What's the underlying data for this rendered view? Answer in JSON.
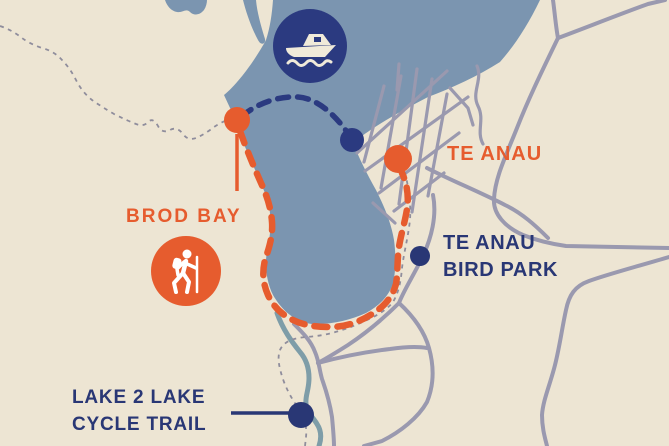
{
  "map": {
    "labels": {
      "te_anau": "TE ANAU",
      "brod_bay": "BROD BAY",
      "bird_park_line1": "TE ANAU",
      "bird_park_line2": "BIRD PARK",
      "cycle_trail_line1": "LAKE 2 LAKE",
      "cycle_trail_line2": "CYCLE TRAIL"
    },
    "colors": {
      "background_cream": "#ede5d3",
      "lake_blue": "#7b95b0",
      "orange_accent": "#e65c2e",
      "navy_accent": "#2b3a80",
      "text_navy": "#293775",
      "road_gray": "#9a99af",
      "trail_dot_gray": "#8f8d9c",
      "river_teal": "#7e9da8",
      "icon_cream": "#f0ead9"
    },
    "icons": [
      {
        "name": "boat-icon",
        "meaning": "boat cruise marker"
      },
      {
        "name": "hiker-icon",
        "meaning": "walking track marker"
      }
    ],
    "markers": [
      {
        "name": "brod-bay-marker",
        "color": "#e65c2e"
      },
      {
        "name": "boat-harbor-dot",
        "color": "#2b3a80"
      },
      {
        "name": "te-anau-dot",
        "color": "#e65c2e"
      },
      {
        "name": "bird-park-dot",
        "color": "#2b3a80"
      },
      {
        "name": "cycle-trail-dot",
        "color": "#2b3a80"
      }
    ],
    "routes": [
      {
        "name": "boat-route",
        "style": "navy-dashed"
      },
      {
        "name": "walking-track",
        "style": "orange-dashed"
      },
      {
        "name": "cycle-trail-track",
        "style": "gray-dotted"
      }
    ]
  }
}
